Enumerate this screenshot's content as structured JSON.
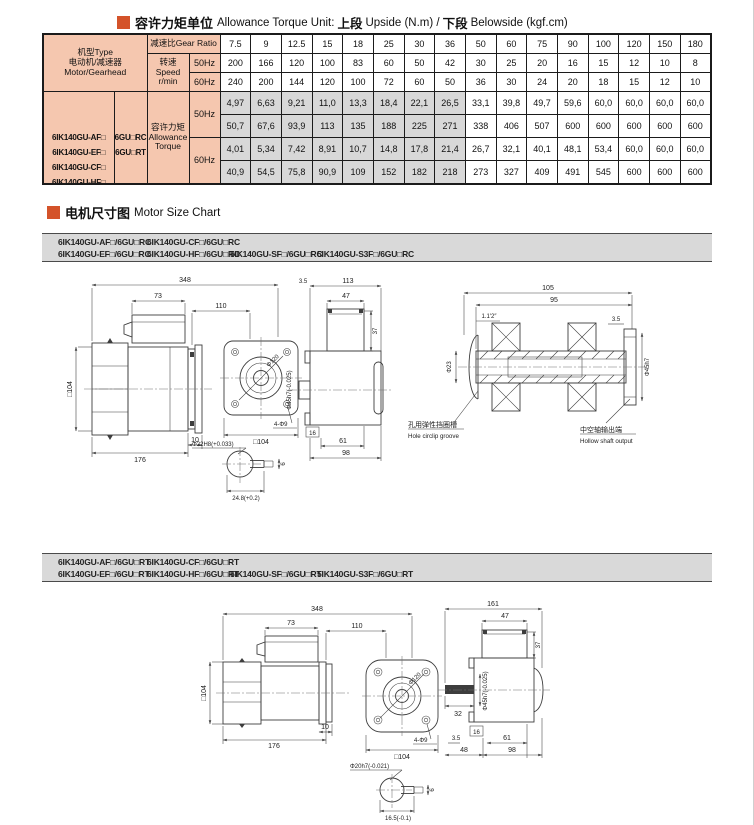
{
  "torque_header": {
    "title_zh": "容许力矩单位",
    "title_en": "Allowance Torque Unit:",
    "upper_zh": "上段",
    "upper_en": "Upside (N.m) /",
    "lower_zh": "下段",
    "lower_en": "Belowside (kgf.cm)"
  },
  "torque_table": {
    "type_line1": "机型Type",
    "type_line2": "电动机/减速器",
    "type_line3": "Motor/Gearhead",
    "gear_ratio_label": "减速比Gear Ratio",
    "speed_label": "转速Speed",
    "speed_unit": "r/min",
    "hz50": "50Hz",
    "hz60": "60Hz",
    "gear_ratios": [
      "7.5",
      "9",
      "12.5",
      "15",
      "18",
      "25",
      "30",
      "36",
      "50",
      "60",
      "75",
      "90",
      "100",
      "120",
      "150",
      "180"
    ],
    "speed_50hz": [
      "200",
      "166",
      "120",
      "100",
      "83",
      "60",
      "50",
      "42",
      "30",
      "25",
      "20",
      "16",
      "15",
      "12",
      "10",
      "8"
    ],
    "speed_60hz": [
      "240",
      "200",
      "144",
      "120",
      "100",
      "72",
      "60",
      "50",
      "36",
      "30",
      "24",
      "20",
      "18",
      "15",
      "12",
      "10"
    ],
    "models": [
      "6IK140GU-AF□",
      "6IK140GU-EF□",
      "6IK140GU-CF□",
      "6IK140GU-HF□",
      "6IK140GU-SF□",
      "6IK140GU-S3F□"
    ],
    "gearheads": [
      "6GU□RC",
      "6GU□RT"
    ],
    "allowance_zh": "容许力矩",
    "allowance_en1": "Allowance",
    "allowance_en2": "Torque",
    "torque_50hz_nm": [
      "4,97",
      "6,63",
      "9,21",
      "11,0",
      "13,3",
      "18,4",
      "22,1",
      "26,5",
      "33,1",
      "39,8",
      "49,7",
      "59,6",
      "60,0",
      "60,0",
      "60,0",
      "60,0"
    ],
    "torque_50hz_kgfcm": [
      "50,7",
      "67,6",
      "93,9",
      "113",
      "135",
      "188",
      "225",
      "271",
      "338",
      "406",
      "507",
      "600",
      "600",
      "600",
      "600",
      "600"
    ],
    "torque_60hz_nm": [
      "4,01",
      "5,34",
      "7,42",
      "8,91",
      "10,7",
      "14,8",
      "17,8",
      "21,4",
      "26,7",
      "32,1",
      "40,1",
      "48,1",
      "53,4",
      "60,0",
      "60,0",
      "60,0"
    ],
    "torque_60hz_kgfcm": [
      "40,9",
      "54,5",
      "75,8",
      "90,9",
      "109",
      "152",
      "182",
      "218",
      "273",
      "327",
      "409",
      "491",
      "545",
      "600",
      "600",
      "600"
    ]
  },
  "size_header": {
    "title_zh": "电机尺寸图",
    "title_en": "Motor Size Chart"
  },
  "rc_bar": {
    "line1": [
      "6IK140GU-AF□/6GU□RC",
      "6IK140GU-CF□/6GU□RC"
    ],
    "line2": [
      "6IK140GU-EF□/6GU□RC",
      "6IK140GU-HF□/6GU□RC",
      "5IK140GU-SF□/6GU□RC",
      "5IK140GU-S3F□/6GU□RC"
    ]
  },
  "rt_bar": {
    "line1": [
      "6IK140GU-AF□/6GU□RT",
      "6IK140GU-CF□/6GU□RT"
    ],
    "line2": [
      "6IK140GU-EF□/6GU□RT",
      "6IK140GU-HF□/6GU□RT",
      "5IK140GU-SF□/6GU□RT",
      "5IK140GU-S3F□/6GU□RT"
    ]
  },
  "drawing_rc": {
    "len_total": "348",
    "len_box": "73",
    "len_gear": "110",
    "frame": "□104",
    "len_motor": "176",
    "len_flange": "10",
    "face_frame": "□104",
    "face_bc": "Φ120",
    "face_holes": "4-Φ9",
    "s_offset": "3.5",
    "s_total": "113",
    "s_box_w": "47",
    "s_box_h": "37",
    "s_shaft": "Φ45h7(-0.025)",
    "s_d16": "16",
    "s_d61": "61",
    "s_d98": "98",
    "x_total": "105",
    "x_inner": "95",
    "x_taper": "1.1′2″",
    "x_edge": "3.5",
    "x_bore": "Φ23",
    "x_hub": "Φ45h7",
    "note_circlip_zh": "孔用弹性挡圈槽",
    "note_circlip_en": "Hole circlip groove",
    "note_hollow_zh": "中空轴输出端",
    "note_hollow_en": "Hollow shaft output",
    "k_bore": "Φ22H8(+0.033)",
    "k_width": "24.8(+0.2)",
    "k_key": "6"
  },
  "drawing_rt": {
    "len_total": "348",
    "len_box": "73",
    "len_gear": "110",
    "frame": "□104",
    "len_motor": "176",
    "len_flange": "10",
    "face_frame": "□104",
    "face_bc": "Φ120",
    "face_holes": "4-Φ9",
    "r_total": "161",
    "r_box_w": "47",
    "r_box_h": "37",
    "r_shaft": "Φ45h7(-0.025)",
    "r_shaft_len": "32",
    "r_d16": "16",
    "r_d35": "3.5",
    "r_d48": "48",
    "r_d61": "61",
    "r_d98": "98",
    "k_bore": "Φ20h7(-0.021)",
    "k_width": "16.5(-0.1)",
    "k_key": "6"
  }
}
